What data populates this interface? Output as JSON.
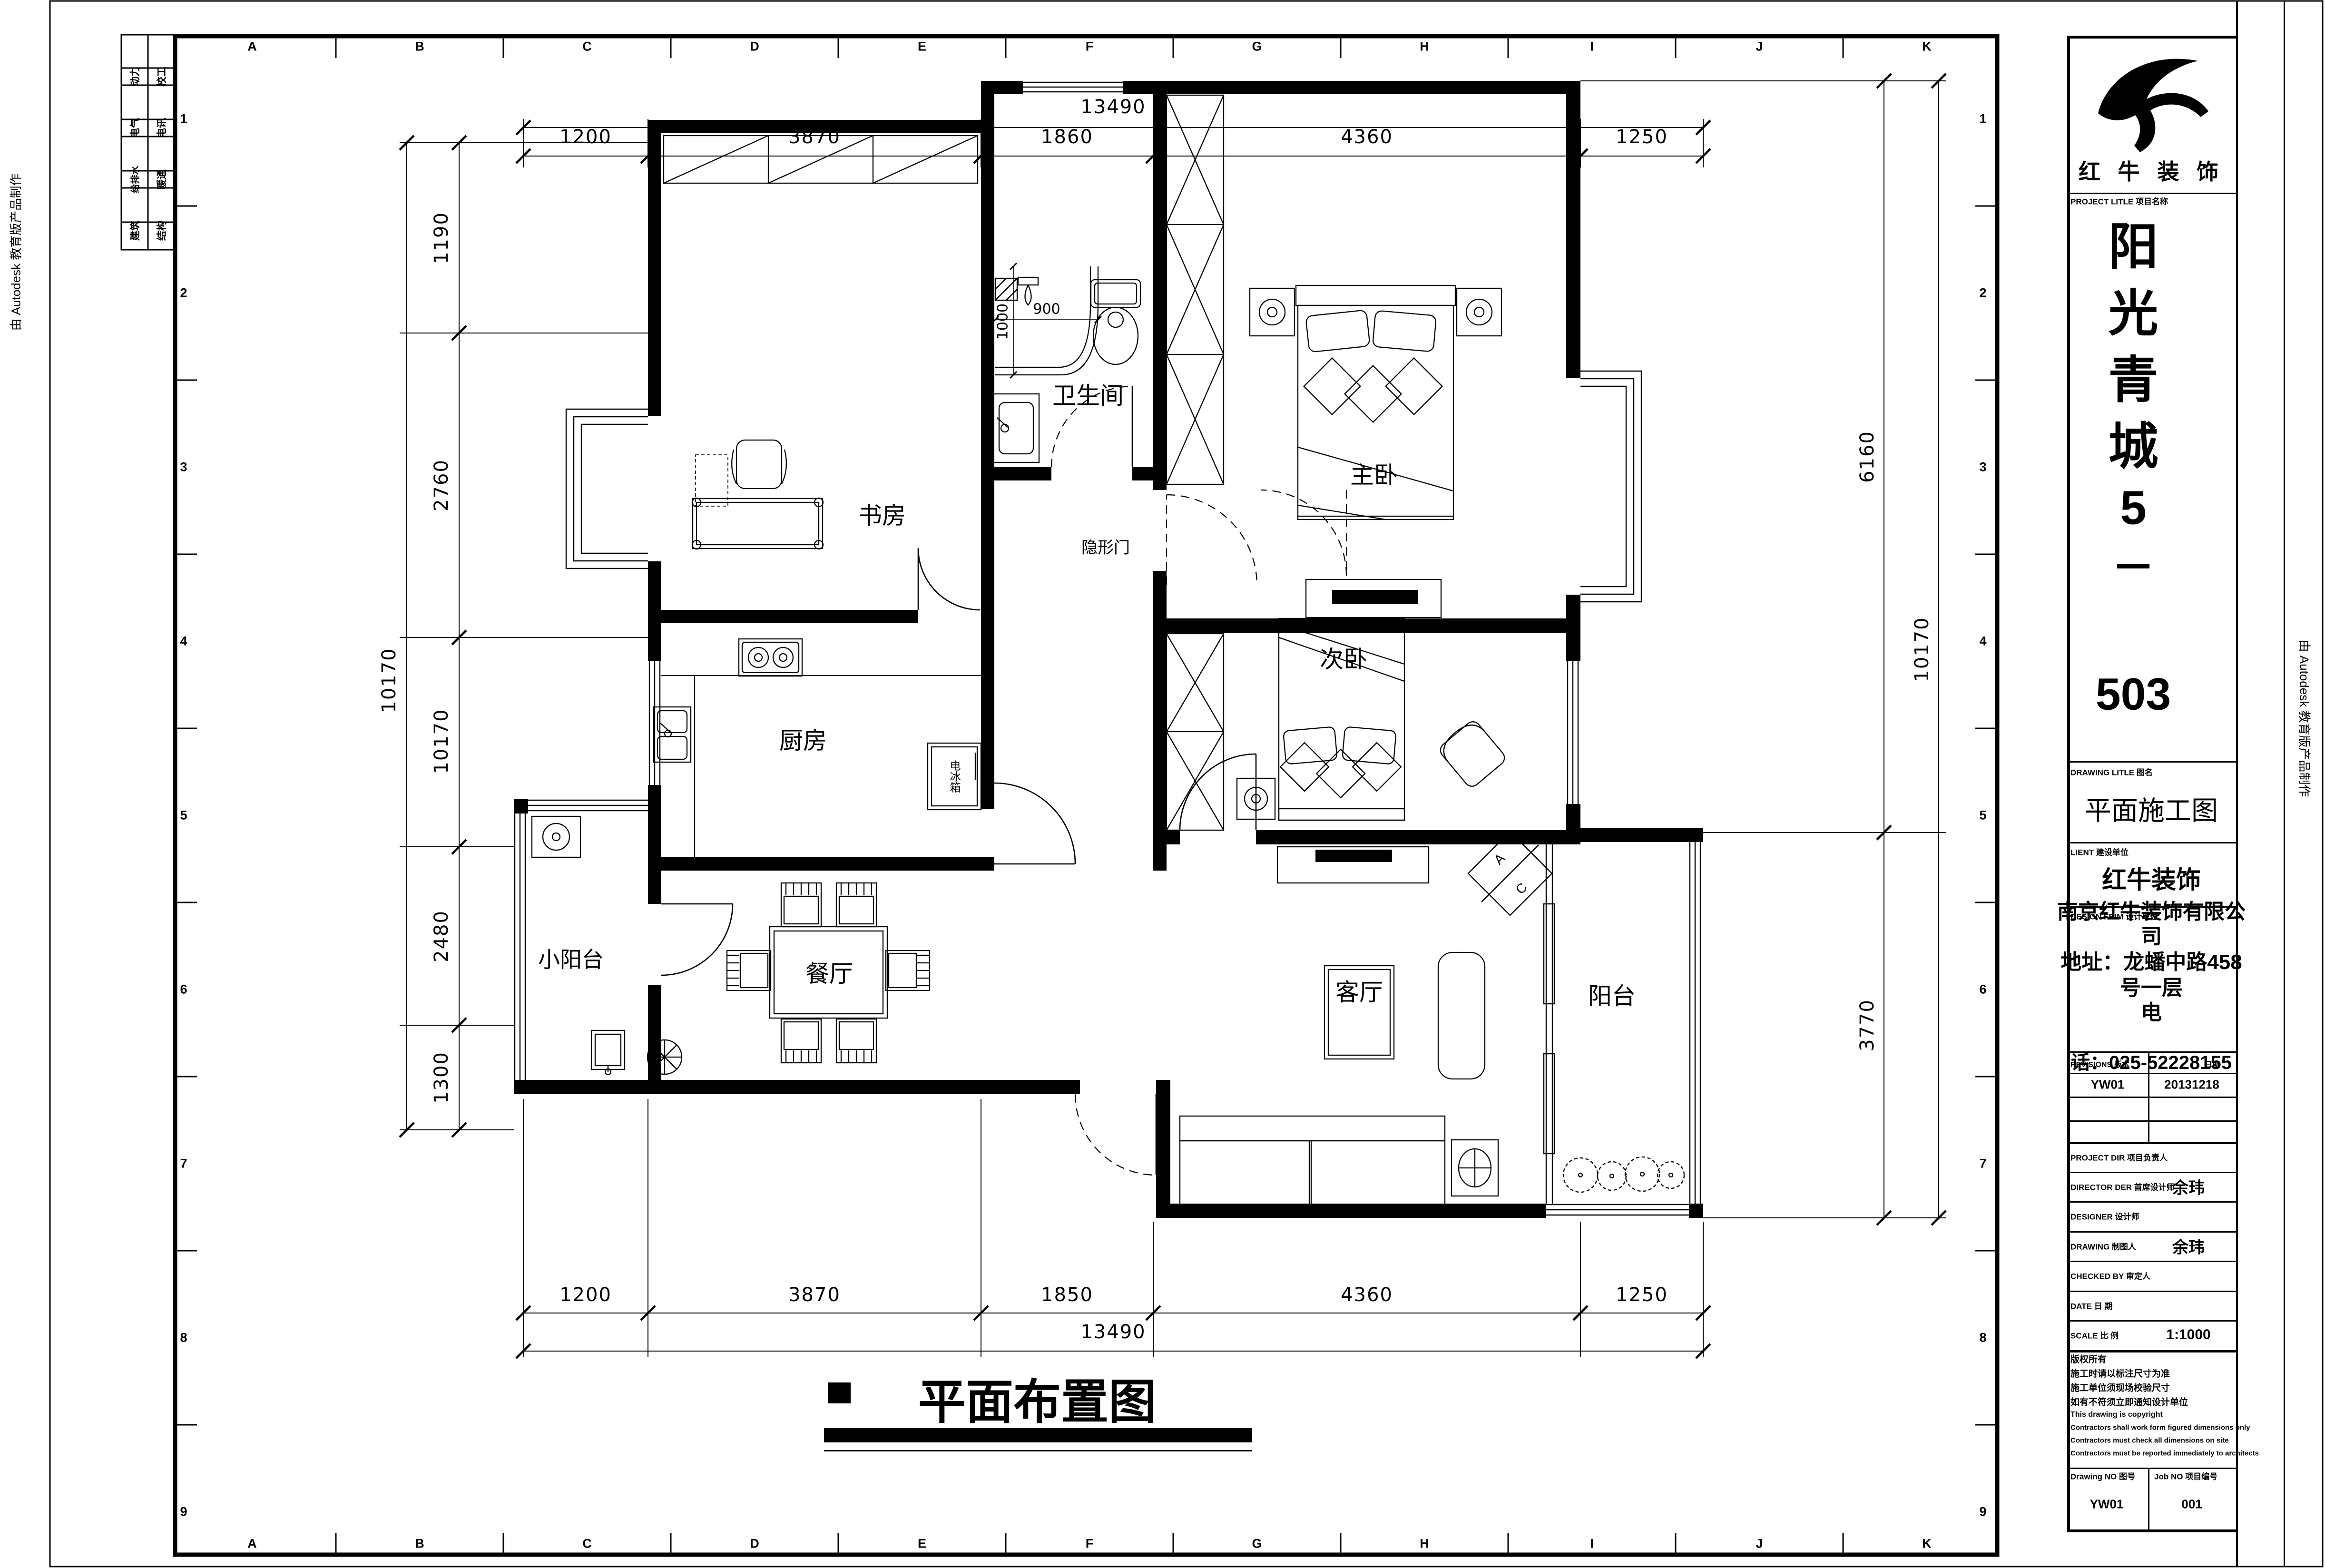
{
  "watermark": {
    "left": "由 Autodesk 教育版产品制作",
    "right": "由 Autodesk 教育版产品制作"
  },
  "grid": {
    "letters": [
      "A",
      "B",
      "C",
      "D",
      "E",
      "F",
      "G",
      "H",
      "I",
      "J",
      "K"
    ],
    "numbers": [
      "1",
      "2",
      "3",
      "4",
      "5",
      "6",
      "7",
      "8",
      "9"
    ]
  },
  "discipline_table": {
    "col1": [
      "动力",
      "电气",
      "给排水",
      "建筑"
    ],
    "col2": [
      "校工",
      "电讯",
      "暖通",
      "结构"
    ]
  },
  "plan": {
    "rooms": {
      "study": "书房",
      "bath": "卫生间",
      "master": "主卧",
      "second": "次卧",
      "kitchen": "厨房",
      "dining": "餐厅",
      "living": "客厅",
      "small_balcony": "小阳台",
      "balcony": "阳台"
    },
    "annotations": {
      "hidden_door": "隐形门",
      "fridge": "电冰箱",
      "ac_top": "A",
      "ac_bottom": "C",
      "shower_width": "900",
      "shower_depth": "1000"
    },
    "title": "平面布置图"
  },
  "dims": {
    "top": {
      "total": "13490",
      "segments": [
        "1200",
        "3870",
        "1860",
        "4360",
        "1250"
      ]
    },
    "bottom": {
      "total": "13490",
      "segments": [
        "1200",
        "3870",
        "1850",
        "4360",
        "1250"
      ]
    },
    "left": {
      "total": "10170",
      "segments": [
        "1190",
        "2760",
        "10170",
        "2480",
        "1300"
      ]
    },
    "right": {
      "total": "10170",
      "segments": [
        "6160",
        "3770"
      ]
    }
  },
  "title_block": {
    "company": "红 牛 装 饰",
    "project_label": "PROJECT LITLE 项目名称",
    "project_name_chars": [
      "阳",
      "光",
      "青",
      "城",
      "5",
      "－",
      "503"
    ],
    "drawing_label": "DRAWING LITLE 图名",
    "drawing_title": "平面施工图",
    "client_label": "LIENT 建设单位",
    "client": "红牛装饰",
    "design_firm_label": "DESIGN FRIM 设计单位",
    "design_firm_lines": [
      "南京红牛装饰有限公",
      "司",
      "地址：龙蟠中路458",
      "号一层",
      "电"
    ],
    "phone_line": "话：025-52228155",
    "revisions_label": "REVISIONS 版本",
    "date_label": "日期",
    "revision_no": "YW01",
    "revision_date": "20131218",
    "rows": [
      {
        "label": "PROJECT DIR  项目负责人",
        "value": ""
      },
      {
        "label": "DIRECTOR DER 首席设计师",
        "value": "余玮"
      },
      {
        "label": "DESIGNER  设计师",
        "value": ""
      },
      {
        "label": "DRAWING  制图人",
        "value": "余玮"
      },
      {
        "label": "CHECKED BY  审定人",
        "value": ""
      },
      {
        "label": "DATE  日  期",
        "value": ""
      },
      {
        "label": "SCALE  比  例",
        "value": "1:1000"
      }
    ],
    "copyright_lines": [
      "版权所有",
      "施工时请以标注尺寸为准",
      "施工单位须现场校验尺寸",
      "如有不符须立即通知设计单位",
      "This drawing is copyright",
      "Contractors shall work form figured dimensions only",
      "Contractors must check all dimensions on site",
      "Contractors must be reported immediately to architects"
    ],
    "drawing_no_label": "Drawing NO 图号",
    "drawing_no": "YW01",
    "job_no_label": "Job NO 项目编号",
    "job_no": "001"
  }
}
